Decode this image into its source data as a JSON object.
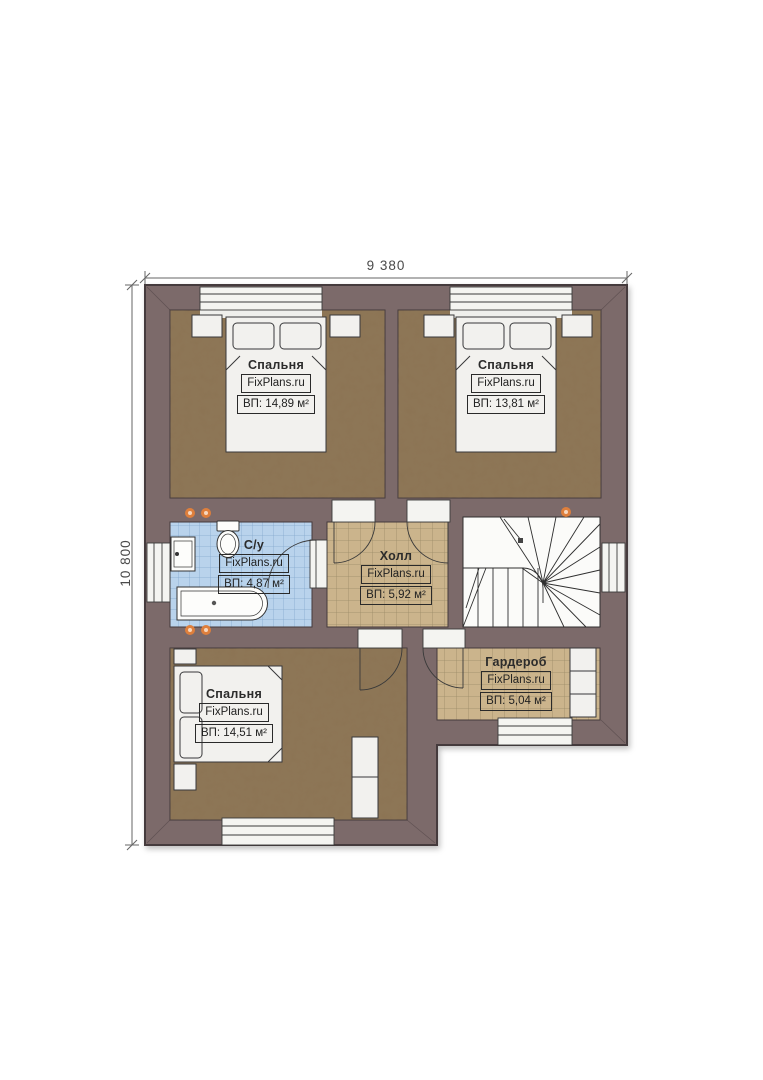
{
  "dimensions": {
    "width_label": "9 380",
    "height_label": "10 800"
  },
  "rooms": [
    {
      "name": "Спальня",
      "brand": "FixPlans.ru",
      "area": "ВП: 14,89 м²"
    },
    {
      "name": "Спальня",
      "brand": "FixPlans.ru",
      "area": "ВП: 13,81 м²"
    },
    {
      "name": "С/у",
      "brand": "FixPlans.ru",
      "area": "ВП: 4,87 м²"
    },
    {
      "name": "Холл",
      "brand": "FixPlans.ru",
      "area": "ВП: 5,92 м²"
    },
    {
      "name": "Гардероб",
      "brand": "FixPlans.ru",
      "area": "ВП: 5,04 м²"
    },
    {
      "name": "Спальня",
      "brand": "FixPlans.ru",
      "area": "ВП: 14,51 м²"
    }
  ],
  "colors": {
    "wall": "#7c6a6b",
    "wall_outline": "#453a3c",
    "bedroom_floor": "#8c7454",
    "hall_floor": "#cbb48c",
    "bath_floor": "#b9d3ec",
    "fixture_white": "#f2f1ee",
    "accent_dot": "#de7f3c",
    "dimension_text": "#4a4a4a"
  }
}
